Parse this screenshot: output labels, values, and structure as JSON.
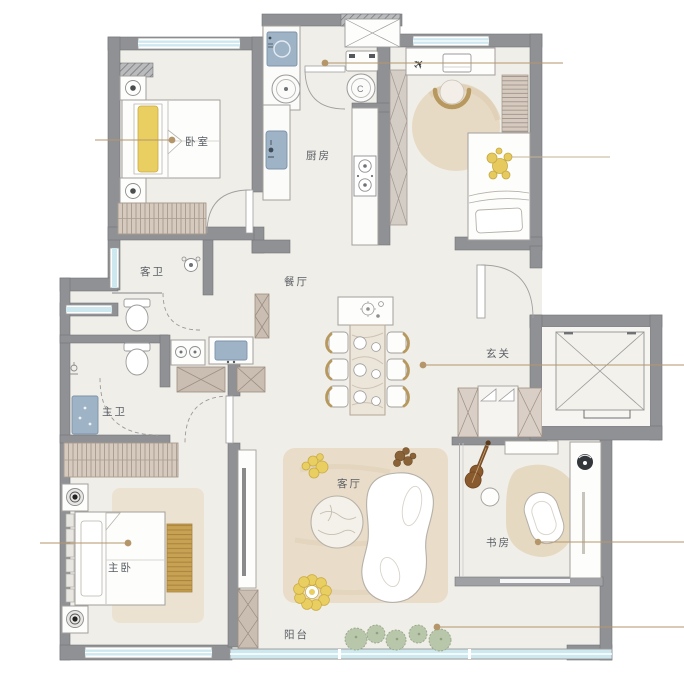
{
  "floorplan": {
    "rooms": {
      "bedroom": {
        "label": "卧室"
      },
      "kitchen": {
        "label": "厨房"
      },
      "guest_bath": {
        "label": "客卫"
      },
      "dining": {
        "label": "餐厅"
      },
      "foyer": {
        "label": "玄关"
      },
      "master_bath": {
        "label": "主卫"
      },
      "master_bedroom": {
        "label": "主卧"
      },
      "living_room": {
        "label": "客厅"
      },
      "study": {
        "label": "书房"
      },
      "balcony": {
        "label": "阳台"
      }
    },
    "appliances": {
      "dryer_label": "C"
    },
    "icons": {
      "airplane": "✈"
    },
    "colors": {
      "background": "#ffffff",
      "floor": "#f0eee8",
      "wall": "#8f9194",
      "window": "#cde8ef",
      "furniture_outline": "#a3a09b",
      "rug": "#e9ddc9",
      "wood_cabinet": "#cabdb2",
      "accent_yellow": "#e9ce62",
      "accent_gold": "#c8a254",
      "appliance_blue": "#9fb3c6",
      "plant_green": "#b8c6aa",
      "leader_line": "#b5966b",
      "label_text": "#585d63"
    }
  }
}
